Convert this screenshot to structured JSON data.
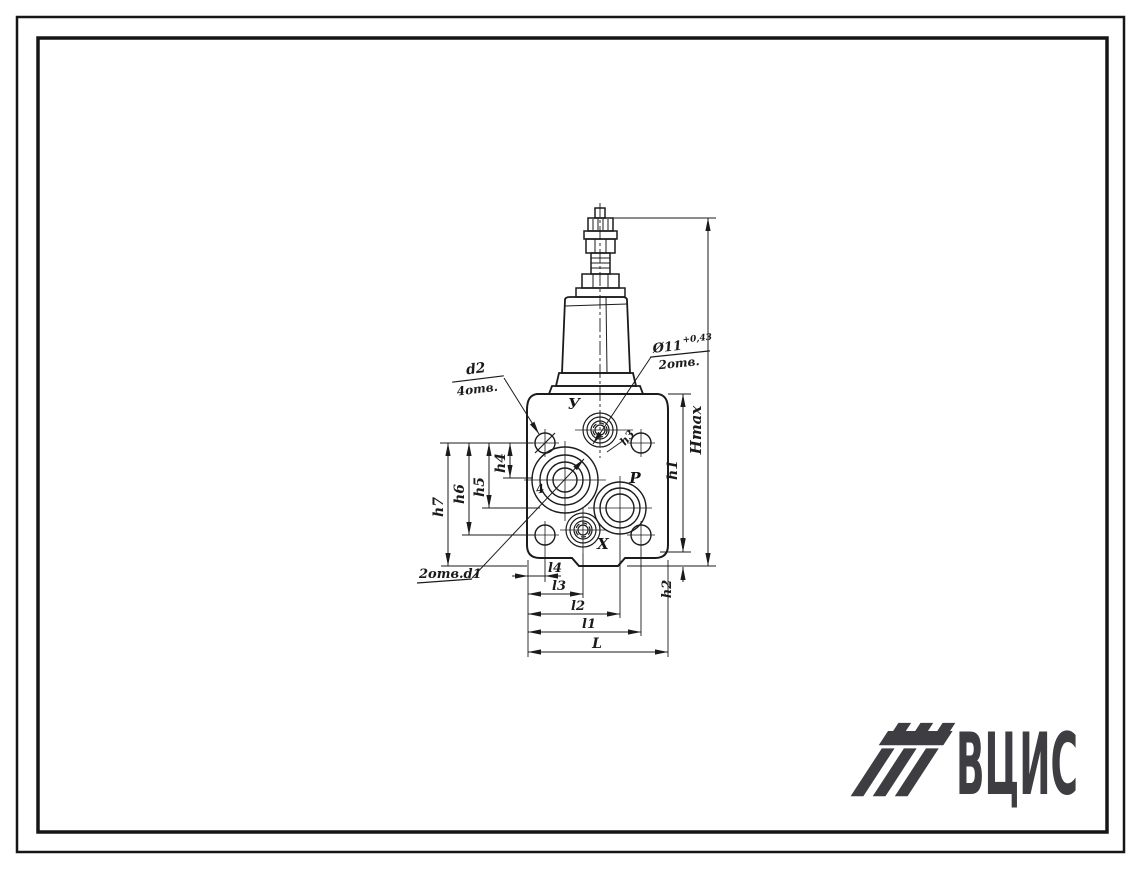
{
  "drawing": {
    "dimension_labels": {
      "h1": "h1",
      "h2": "h2",
      "h3": "h3",
      "h4": "h4",
      "h5": "h5",
      "h6": "h6",
      "h7": "h7",
      "hmax": "Hmax",
      "l1": "l1",
      "l2": "l2",
      "l3": "l3",
      "l4": "l4",
      "L": "L"
    },
    "port_labels": {
      "top": "У",
      "right": "Р",
      "bottom": "Х",
      "left": "4"
    },
    "callouts": {
      "corner_holes": {
        "dia": "d2",
        "qty": "4отв."
      },
      "control_holes": {
        "dia": "Ø11",
        "tolerance": "+0,43",
        "qty": "2отв."
      },
      "bottom_holes": {
        "label": "2отв.d1"
      }
    }
  },
  "logo": {
    "text": "ВЦИС",
    "color": "#3e3e42"
  },
  "colors": {
    "ink": "#1b1b1b",
    "background": "#ffffff"
  }
}
